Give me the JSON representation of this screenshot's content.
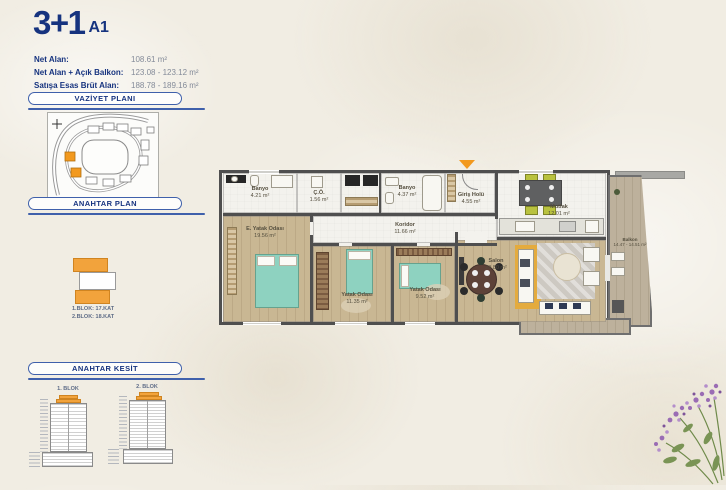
{
  "colors": {
    "accent_blue": "#16337f",
    "panel_blue": "#3f60ab",
    "highlight_orange": "#f2991e",
    "wall_gray": "#4f4f4f",
    "wood_floor": "#c9b793",
    "bed_teal": "#8ed2c0",
    "rug_yellow": "#e4ab3e"
  },
  "header": {
    "title": "3+1",
    "variant": "A1",
    "info_rows": [
      {
        "label": "Net Alan:",
        "value": "108.61 m²"
      },
      {
        "label": "Net Alan + Açık Balkon:",
        "value": "123.08 - 123.12 m²"
      },
      {
        "label": "Satışa Esas Brüt Alan:",
        "value": "188.78 - 189.16 m²"
      }
    ]
  },
  "panels": {
    "site_plan": {
      "title": "VAZİYET PLANI"
    },
    "key_plan": {
      "title": "ANAHTAR PLAN",
      "caption_line1": "1.BLOK: 17.KAT",
      "caption_line2": "2.BLOK: 18.KAT"
    },
    "key_section": {
      "title": "ANAHTAR KESİT",
      "block1_label": "1. BLOK",
      "block2_label": "2. BLOK"
    }
  },
  "floor_plan": {
    "rooms": {
      "banyo1": {
        "name": "Banyo",
        "area": "4.21 m²"
      },
      "co": {
        "name": "Ç.Ö.",
        "area": "1.56 m²"
      },
      "banyo2": {
        "name": "Banyo",
        "area": "4.37 m²"
      },
      "giris": {
        "name": "Giriş Holü",
        "area": "4.55 m²"
      },
      "mutfak": {
        "name": "Mutfak",
        "area": "12.01 m²"
      },
      "koridor": {
        "name": "Koridor",
        "area": "11.66 m²"
      },
      "e_yatak": {
        "name": "E. Yatak Odası",
        "area": "19.56 m²"
      },
      "yatak1": {
        "name": "Yatak Odası",
        "area": "11.35 m²"
      },
      "yatak2": {
        "name": "Yatak Odası",
        "area": "9.52 m²"
      },
      "salon": {
        "name": "Salon",
        "area": "29.80 m²"
      },
      "balkon": {
        "name": "Balkon",
        "area": "14.47 - 14.51 m²"
      }
    }
  }
}
